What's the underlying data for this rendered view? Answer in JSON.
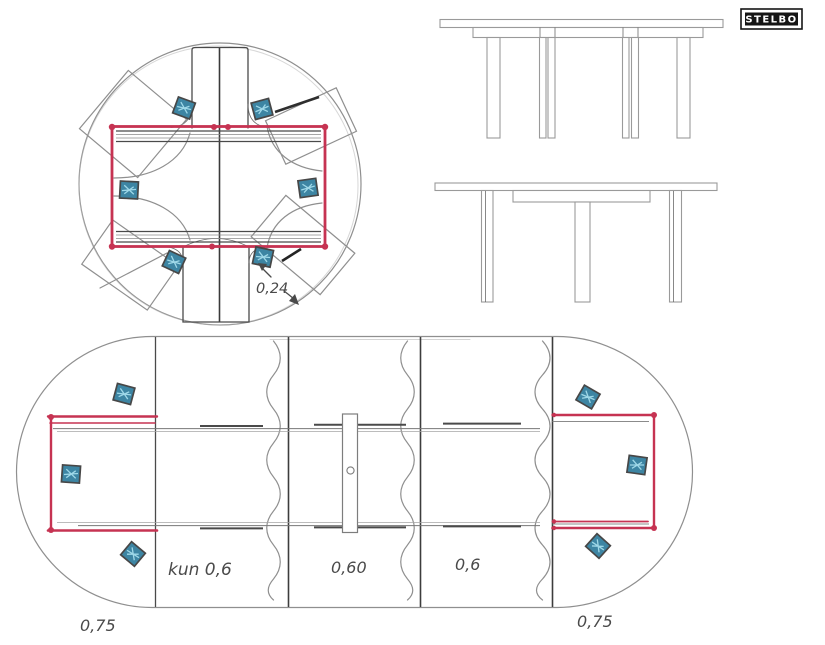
{
  "logo": {
    "text": "STELBO"
  },
  "annotations": {
    "leg_inset": "0,24",
    "section_left": "kun 0,6",
    "section_middle": "0,60",
    "section_right": "0,6",
    "end_left": "0,75",
    "end_right": "0,75"
  },
  "colors": {
    "frame_red": "#c63352",
    "leg_fill": "#3d85a3",
    "leg_accent": "#9fd8e8",
    "pencil_gray": "#8f8f8f",
    "ink_gray": "#4a4a4a"
  },
  "views": {
    "round_plan": "round table plan with extension frame",
    "elevation_extended": "side elevation, extended table",
    "elevation_round": "side elevation, round table",
    "oval_plan": "extended oval table plan"
  }
}
